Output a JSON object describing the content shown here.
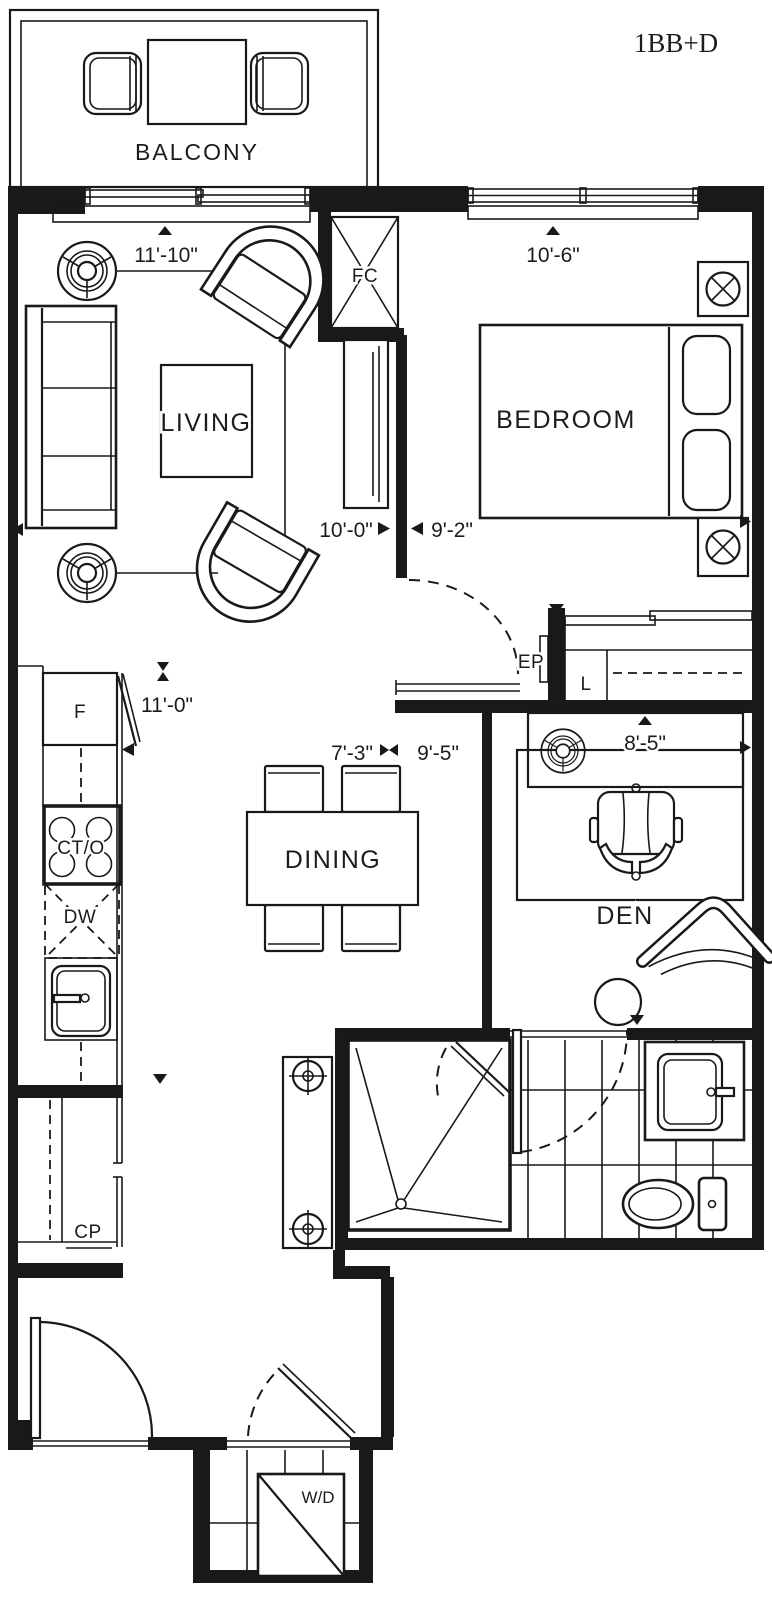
{
  "title": {
    "label": "1BB+D",
    "color": "#e2342c"
  },
  "rooms": {
    "balcony": "BALCONY",
    "living": "LIVING",
    "bedroom": "BEDROOM",
    "dining": "DINING",
    "den": "DEN"
  },
  "fixtures": {
    "fan_coil": "FC",
    "electrical_panel": "EP",
    "linen_closet": "L",
    "fridge": "F",
    "cooktop_oven": "CT/O",
    "dishwasher": "DW",
    "coat_pantry": "CP",
    "washer_dryer": "W/D"
  },
  "dimensions": {
    "living_width": "11'-10\"",
    "bedroom_width": "10'-6\"",
    "living_depth": "10'-0\"",
    "bedroom_depth": "9'-2\"",
    "kitchen_run": "11'-0\"",
    "dining_width": "7'-3\"",
    "dining_depth": "9'-5\"",
    "den_width": "8'-5\""
  },
  "colors": {
    "line": "#191919",
    "background": "#ffffff"
  }
}
